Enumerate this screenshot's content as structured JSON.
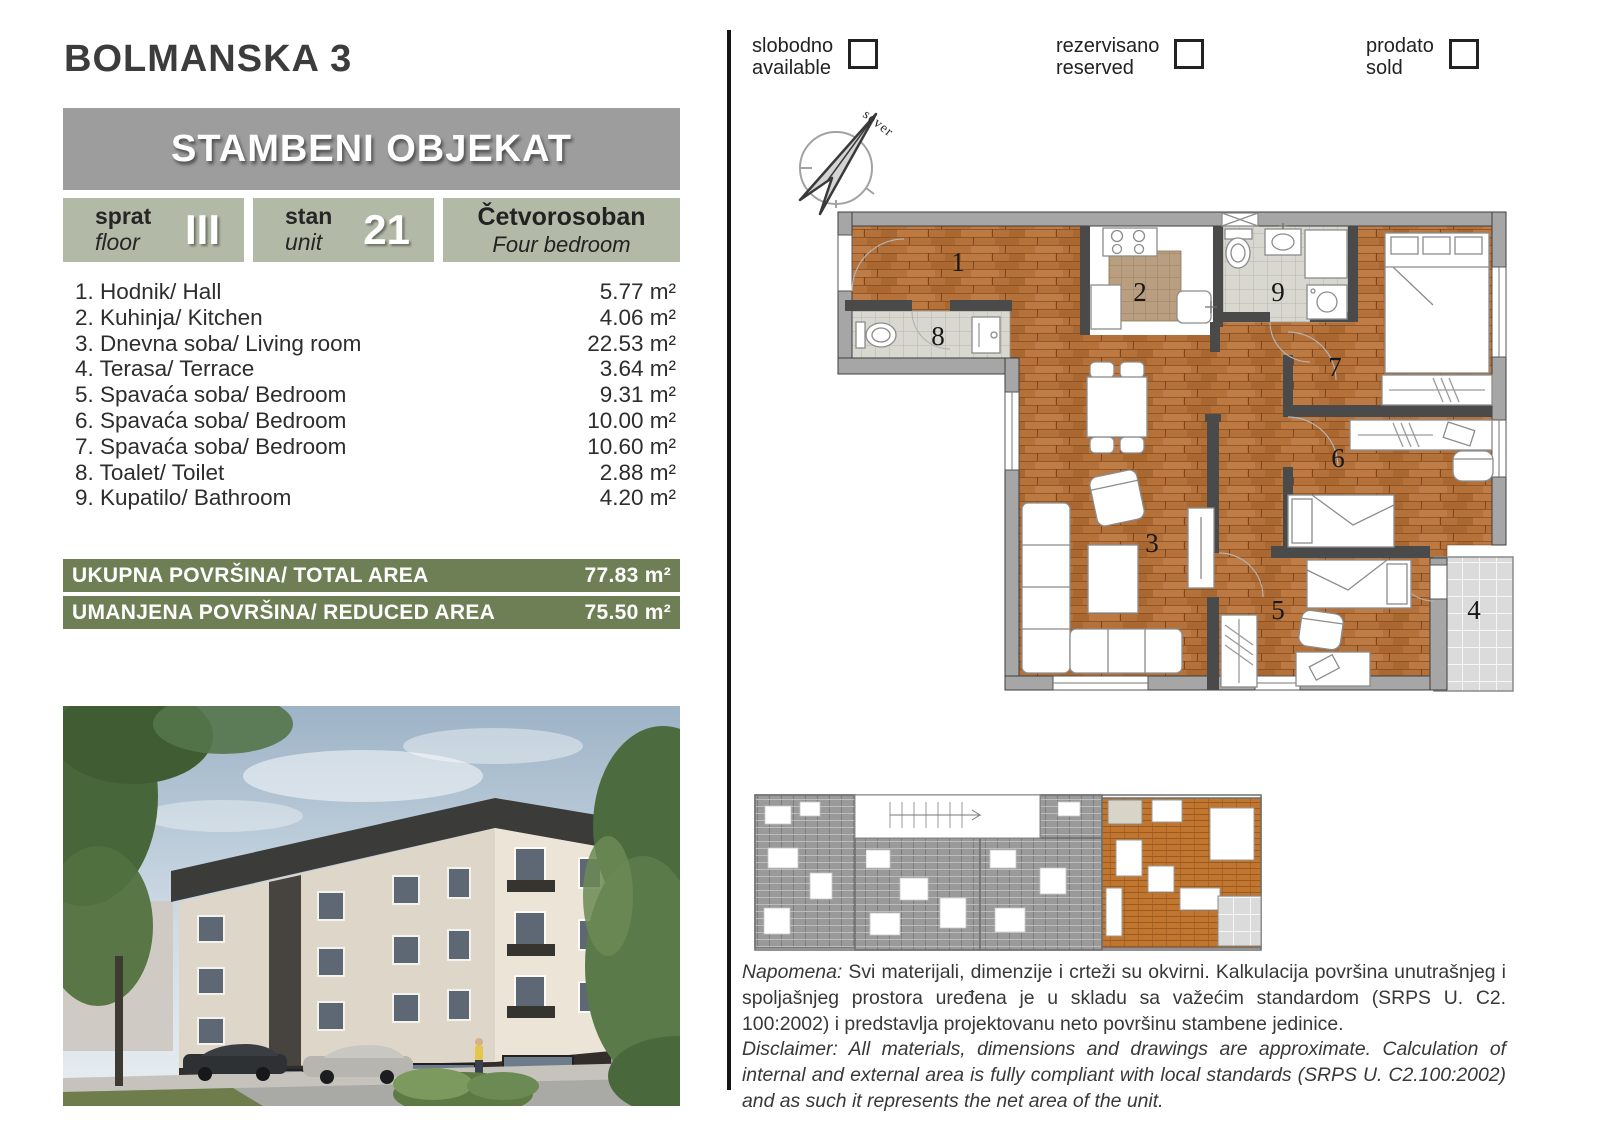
{
  "page": {
    "title": "BOLMANSKA 3"
  },
  "banner": {
    "title": "STAMBENI OBJEKAT"
  },
  "info": {
    "floor_label_sr": "sprat",
    "floor_label_en": "floor",
    "floor_value": "III",
    "unit_label_sr": "stan",
    "unit_label_en": "unit",
    "unit_value": "21",
    "type_sr": "Četvorosoban",
    "type_en": "Four bedroom"
  },
  "rooms": [
    {
      "label": "1. Hodnik/ Hall",
      "area": "5.77 m²"
    },
    {
      "label": "2. Kuhinja/ Kitchen",
      "area": "4.06 m²"
    },
    {
      "label": "3. Dnevna soba/ Living room",
      "area": "22.53 m²"
    },
    {
      "label": "4. Terasa/ Terrace",
      "area": "3.64 m²"
    },
    {
      "label": "5. Spavaća soba/ Bedroom",
      "area": "9.31 m²"
    },
    {
      "label": "6. Spavaća soba/ Bedroom",
      "area": "10.00 m²"
    },
    {
      "label": "7. Spavaća soba/ Bedroom",
      "area": "10.60 m²"
    },
    {
      "label": "8. Toalet/ Toilet",
      "area": "2.88 m²"
    },
    {
      "label": "9. Kupatilo/ Bathroom",
      "area": "4.20 m²"
    }
  ],
  "totals": {
    "total_label": "UKUPNA POVRŠINA/ TOTAL AREA",
    "total_value": "77.83 m²",
    "reduced_label": "UMANJENA POVRŠINA/ REDUCED AREA",
    "reduced_value": "75.50 m²"
  },
  "legend": {
    "available_sr": "slobodno",
    "available_en": "available",
    "reserved_sr": "rezervisano",
    "reserved_en": "reserved",
    "sold_sr": "prodato",
    "sold_en": "sold"
  },
  "compass": {
    "label": "sever"
  },
  "plan": {
    "labels": [
      "1",
      "2",
      "3",
      "4",
      "5",
      "6",
      "7",
      "8",
      "9"
    ]
  },
  "notes": {
    "napomena_label": "Napomena:",
    "napomena_text": " Svi materijali, dimenzije i crteži su okvirni. Kalkulacija površina unutrašnjeg i spoljašnjeg prostora uređena je u skladu sa važećim standardom (SRPS U. C2. 100:2002) i predstavlja projektovanu neto površinu stambene jedinice.",
    "disclaimer_label": "Disclaimer:",
    "disclaimer_text": " All materials, dimensions and drawings are approximate. Calculation of internal and external area is fully compliant with local standards (SRPS U. C2.100:2002) and as such it represents the net area of the unit."
  },
  "colors": {
    "sage": "#b2b9a6",
    "olive": "#6f7f55",
    "banner_gray": "#9d9d9d",
    "wood": "#b5713a",
    "highlight_orange": "#c0762e"
  }
}
